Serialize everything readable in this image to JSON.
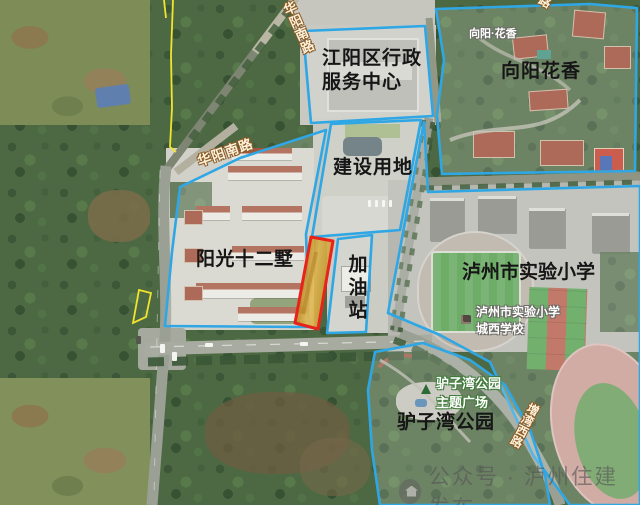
{
  "region_labels": {
    "admin_center": "江阳区行政\n服务中心",
    "xiangyang_huaxiang": "向阳花香",
    "construction_land": "建设用地",
    "sunshine_twelve_villas": "阳光十二墅",
    "gas_station": "加油站",
    "experimental_primary_school": "泸州市实验小学",
    "luzi_bay_park": "驴子湾公园"
  },
  "poi_labels": {
    "xiangyang_huaxiang_poi": "向阳·花香",
    "school_west_campus": "泸州市实验小学\n城西学校",
    "park_theme_plaza": "驴子湾公园\n主题广场"
  },
  "road_labels": {
    "huayang_south_road_top": "华阳南路",
    "huayang_south_road_mid": "华阳南路",
    "southeast_road": "增湾西路",
    "top_edge_partial": "路"
  },
  "watermark": {
    "text": "公众号 · 泸州住建发布"
  },
  "icons": {
    "park_tree_icon": "small green tree triangle",
    "school_poi_icon": "small dark school-building block",
    "watermark_logo_icon": "round gray official-account logo"
  },
  "legend_colors": {
    "boundary_cyan": "#2fa7e5",
    "parcel_fill_orange": "#dda63a",
    "parcel_outline_red": "#e8241a",
    "survey_line_yellow": "#f2e42b"
  }
}
